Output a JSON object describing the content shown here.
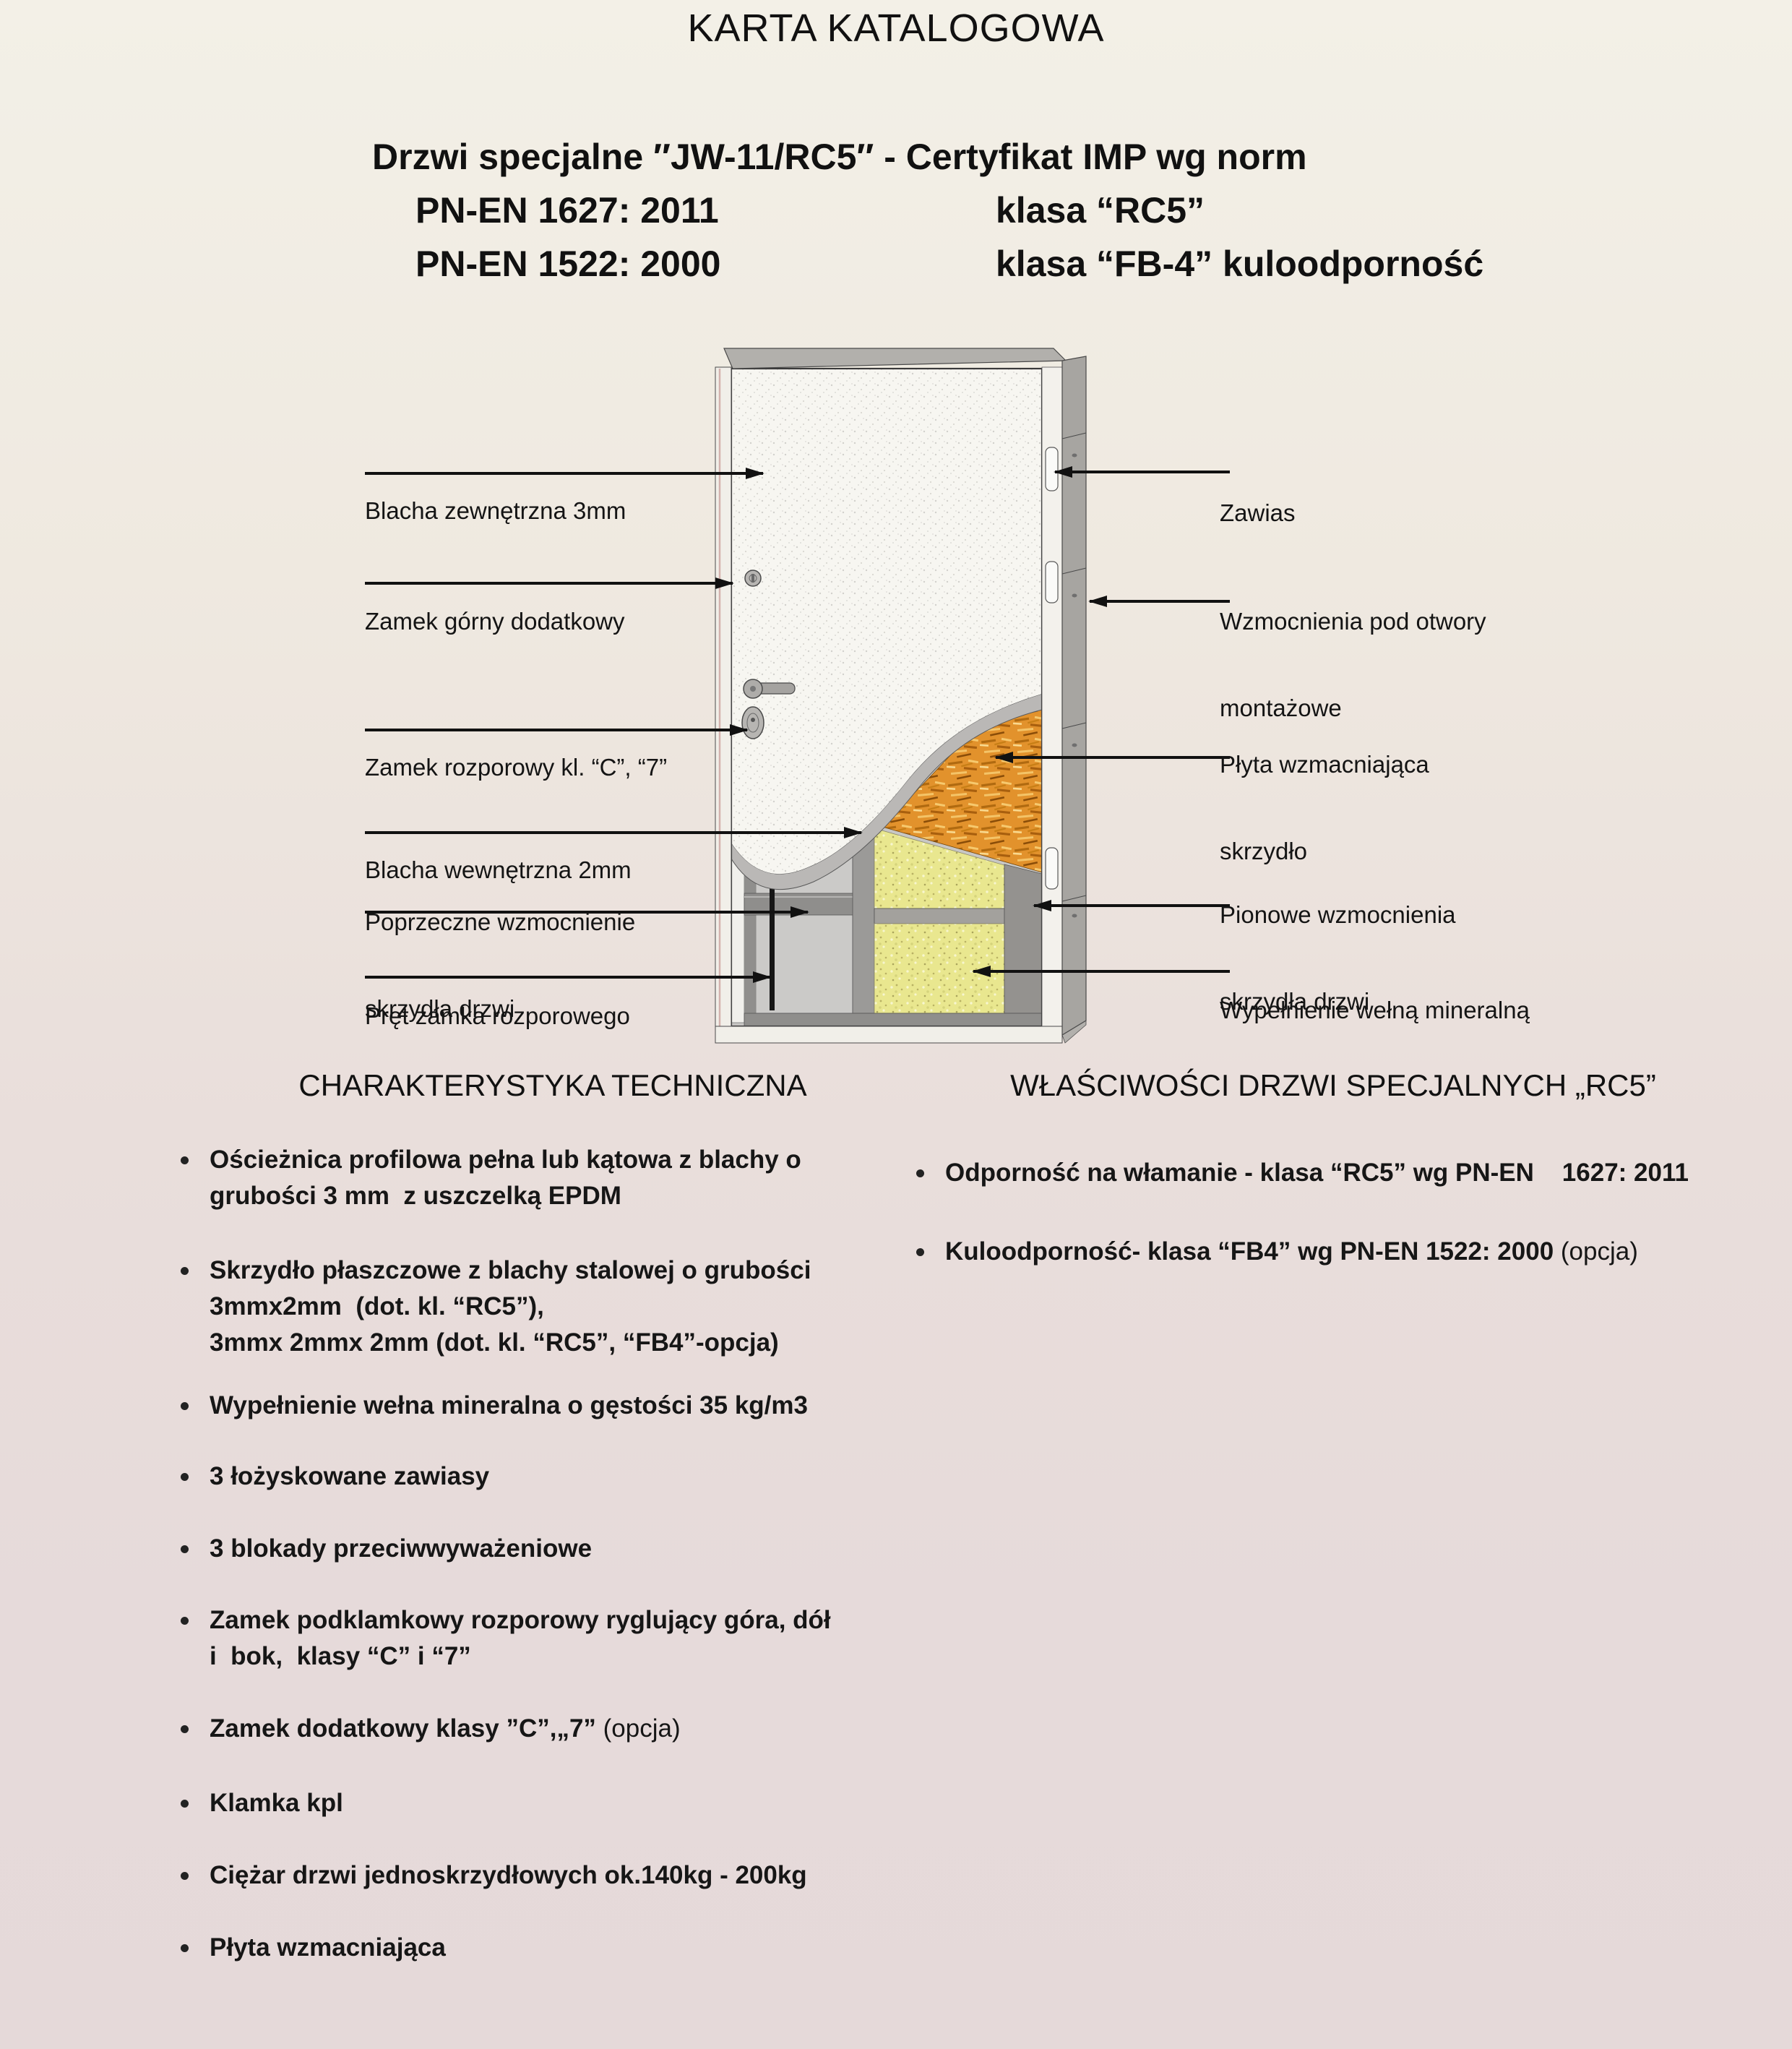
{
  "page": {
    "title": "KARTA KATALOGOWA"
  },
  "header": {
    "product_line": "Drzwi specjalne ″JW-11/RC5″ - Certyfikat IMP wg norm",
    "norms": [
      {
        "norm": "PN-EN 1627: 2011",
        "klasa": "klasa “RC5”"
      },
      {
        "norm": "PN-EN 1522: 2000",
        "klasa": "klasa “FB-4” kuloodporność"
      }
    ]
  },
  "diagram": {
    "left_labels": [
      {
        "line1": "Blacha zewnętrzna 3mm",
        "line2": ""
      },
      {
        "line1": "Zamek górny dodatkowy",
        "line2": ""
      },
      {
        "line1": "Zamek rozporowy kl. “C”, “7”",
        "line2": ""
      },
      {
        "line1": "Blacha wewnętrzna 2mm",
        "line2": ""
      },
      {
        "line1": "Poprzeczne wzmocnienie",
        "line2": "skrzydła drzwi"
      },
      {
        "line1": "Pręt zamka rozporowego",
        "line2": ""
      }
    ],
    "right_labels": [
      {
        "line1": "Zawias",
        "line2": ""
      },
      {
        "line1": "Wzmocnienia pod otwory",
        "line2": "montażowe"
      },
      {
        "line1": "Płyta wzmacniająca",
        "line2": "skrzydło"
      },
      {
        "line1": "Pionowe wzmocnienia",
        "line2": "skrzydła drzwi"
      },
      {
        "line1": "Wypełnienie wełną mineralną",
        "line2": ""
      }
    ],
    "colors": {
      "outer_sheet": "#f7f6f1",
      "inner_sheet_band": "#bab8b6",
      "reinforcing_plate_orange": "#e2922c",
      "mineral_wool_yellow": "#e9e78f",
      "frame_gray": "#a7a5a1",
      "background_top": "#f3f0e7",
      "background_bottom": "#e5d9d9"
    }
  },
  "tech": {
    "heading": "CHARAKTERYSTYKA TECHNICZNA",
    "items": [
      {
        "lines": [
          "Ościeżnica profilowa pełna lub kątowa z blachy o",
          "grubości 3 mm  z uszczelką EPDM"
        ],
        "suffix": ""
      },
      {
        "lines": [
          "Skrzydło płaszczowe z blachy stalowej o grubości",
          "3mmx2mm  (dot. kl. “RC5”),",
          "3mmx 2mmx 2mm (dot. kl. “RC5”, “FB4”-opcja)"
        ],
        "suffix": ""
      },
      {
        "lines": [
          "Wypełnienie wełna mineralna o gęstości 35 kg/m3"
        ],
        "suffix": ""
      },
      {
        "lines": [
          "3 łożyskowane zawiasy"
        ],
        "suffix": ""
      },
      {
        "lines": [
          "3 blokady przeciwwyważeniowe"
        ],
        "suffix": ""
      },
      {
        "lines": [
          "Zamek podklamkowy rozporowy ryglujący góra, dół",
          "i  bok,  klasy “C” i “7”"
        ],
        "suffix": ""
      },
      {
        "lines": [
          "Zamek dodatkowy klasy ”C”,„7”"
        ],
        "suffix": " (opcja)"
      },
      {
        "lines": [
          "Klamka kpl"
        ],
        "suffix": ""
      },
      {
        "lines": [
          "Ciężar drzwi jednoskrzydłowych ok.140kg - 200kg"
        ],
        "suffix": ""
      },
      {
        "lines": [
          "Płyta wzmacniająca"
        ],
        "suffix": ""
      }
    ]
  },
  "props": {
    "heading": "WŁAŚCIWOŚCI DRZWI SPECJALNYCH „RC5”",
    "items": [
      {
        "lines": [
          "Odporność na włamanie - klasa “RC5” wg PN-EN    1627: 2011"
        ],
        "suffix": ""
      },
      {
        "lines": [
          "Kuloodporność- klasa “FB4” wg PN-EN 1522: 2000"
        ],
        "suffix": " (opcja)"
      }
    ]
  }
}
